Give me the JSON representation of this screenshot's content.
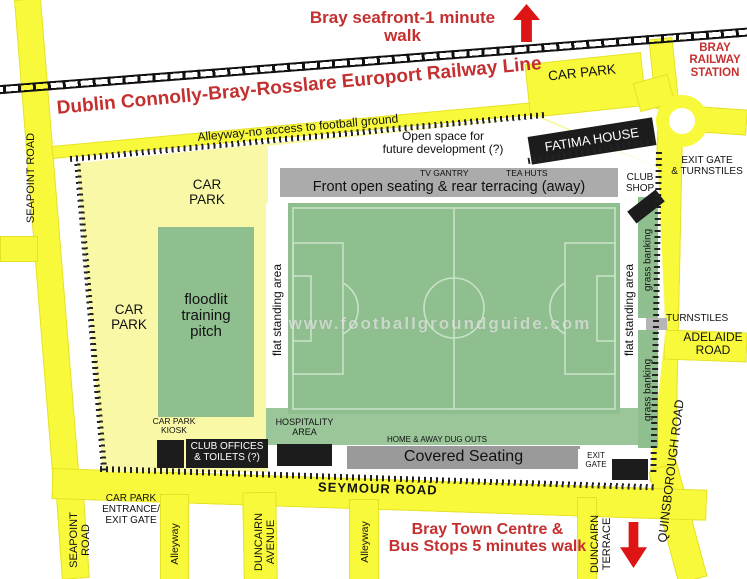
{
  "colors": {
    "road_yellow": "#F9F93C",
    "ground_yellow": "#F8F8A6",
    "pitch_green": "#8FBE8F",
    "apron_green": "#9AC69A",
    "stand_gray": "#ABABAB",
    "covered_gray": "#9A9A9A",
    "block_black": "#1C1C1C",
    "map_red": "#C43030",
    "arrow_red": "#DD1515"
  },
  "top": {
    "seafront_note": "Bray seafront-1 minute walk",
    "railway_line_label": "Dublin Connolly-Bray-Rosslare Europort Railway Line",
    "car_park_station": "CAR PARK",
    "railway_station": "BRAY\nRAILWAY\nSTATION",
    "exit_gate_turnstiles": "EXIT GATE\n& TURNSTILES",
    "fatima_house": "FATIMA HOUSE"
  },
  "roads": {
    "seapoint_upper": "SEAPOINT ROAD",
    "seapoint_lower": "SEAPOINT\nROAD",
    "alleyway_top": "Alleyway-no access to football ground",
    "seymour": "SEYMOUR ROAD",
    "adelaide": "ADELAIDE\nROAD",
    "quinsborough": "QUINSBOROUGH ROAD",
    "duncairn_avenue": "DUNCAIRN\nAVENUE",
    "duncairn_terrace": "DUNCAIRN\nTERRACE",
    "alleyway_south_1": "Alleyway",
    "alleyway_south_2": "Alleyway",
    "turnstiles": "TURNSTILES"
  },
  "ground": {
    "car_park_north": "CAR\nPARK",
    "car_park_west": "CAR\nPARK",
    "training_pitch": "floodlit\ntraining\npitch",
    "open_space": "Open space for\nfuture development (?)",
    "tv_gantry": "TV GANTRY",
    "tea_huts": "TEA HUTS",
    "front_stand": "Front open seating & rear terracing  (away)",
    "club_shop": "CLUB\nSHOP",
    "flat_standing_west": "flat standing area",
    "flat_standing_east": "flat standing area",
    "grass_banking_north": "grass banking",
    "grass_banking_south": "grass banking",
    "hospitality": "HOSPITALITY\nAREA",
    "dugouts": "HOME & AWAY DUG OUTS",
    "covered_seating": "Covered Seating",
    "exit_gate_south": "EXIT\nGATE",
    "car_park_kiosk": "CAR PARK\nKIOSK",
    "club_offices": "CLUB OFFICES\n& TOILETS (?)",
    "car_park_entrance": "CAR PARK\nENTRANCE/\nEXIT GATE"
  },
  "south": {
    "town_centre_note": "Bray Town Centre &\nBus Stops 5 minutes walk"
  },
  "watermark": "www.footballgroundguide.com"
}
